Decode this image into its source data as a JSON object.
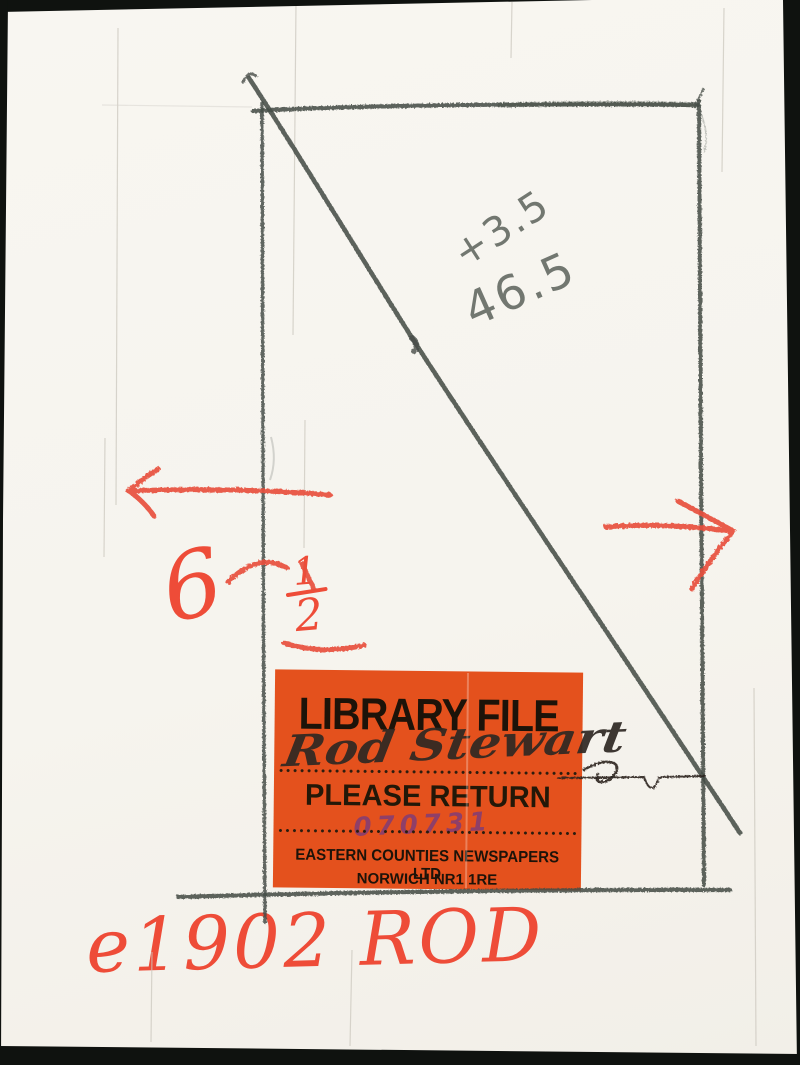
{
  "scan": {
    "background_color": "#0f120f",
    "paper_color": "#f6f4ee"
  },
  "sticker": {
    "title": "LIBRARY FILE",
    "return_label": "PLEASE RETURN",
    "file_number": "070731",
    "company": "EASTERN COUNTIES NEWSPAPERS LTD",
    "address": "NORWICH NR1 1RE",
    "background_color": "#e4511d",
    "file_number_color": "#8f3f68"
  },
  "annotations": {
    "signature": "Rod Stewart",
    "pencil_note_top": "+3.5",
    "pencil_note_bottom": "46.5",
    "red_size_whole": "6",
    "red_size_numerator": "1",
    "red_size_denominator": "2",
    "red_reference": "e1902 ROD",
    "red_color": "#ee4c38",
    "pencil_color": "#474d48"
  }
}
